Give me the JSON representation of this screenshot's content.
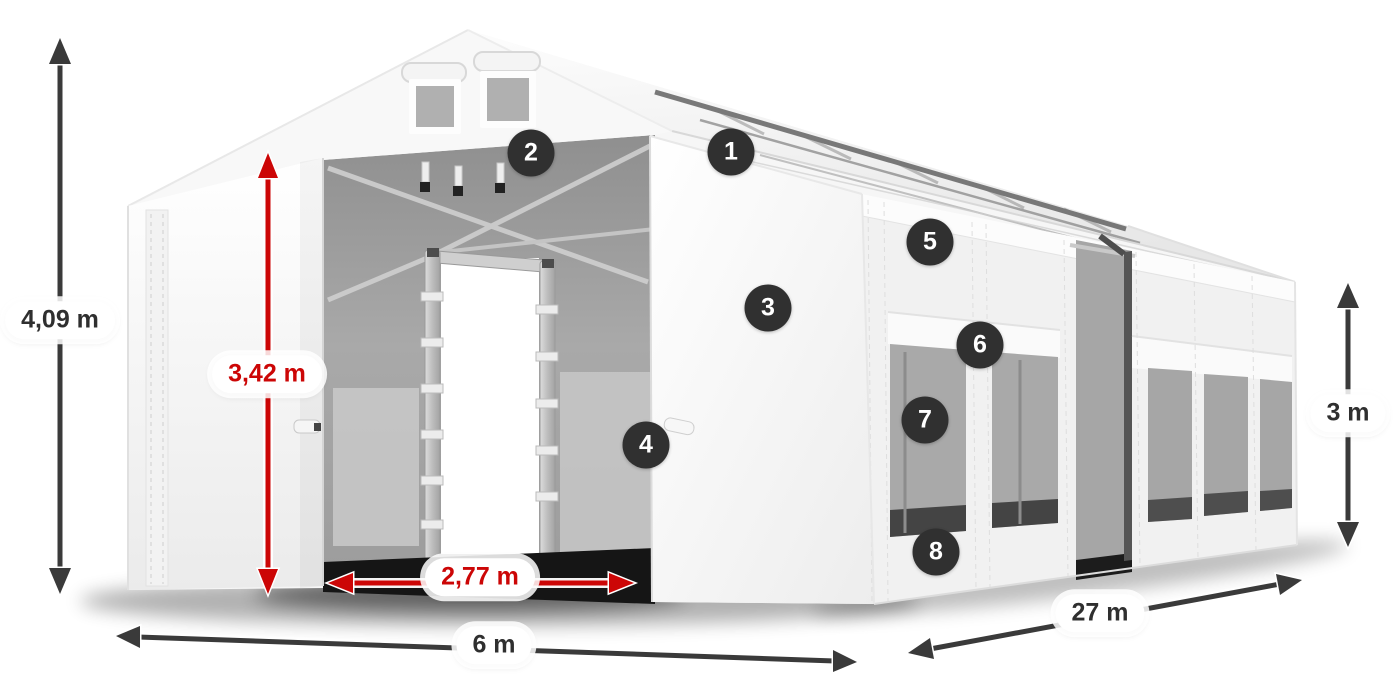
{
  "figure": {
    "type": "product-dimension-diagram",
    "subject": "White storage tent 6 m x 27 m with open front entrance, roof vents and side windows"
  },
  "dimensions": {
    "total_height": "4,09 m",
    "entrance_height": "3,42 m",
    "entrance_width": "2,77 m",
    "front_width": "6 m",
    "length": "27 m",
    "side_height": "3 m"
  },
  "callouts": [
    "1",
    "2",
    "3",
    "4",
    "5",
    "6",
    "7",
    "8"
  ],
  "colors": {
    "dimension_arrow_dark": "#3a3a3a",
    "dimension_arrow_red": "#cc0606",
    "dimension_text_dark": "#2f2f2f",
    "dimension_text_red": "#c40000",
    "callout_badge_bg": "#303030",
    "callout_badge_text": "#ffffff"
  }
}
